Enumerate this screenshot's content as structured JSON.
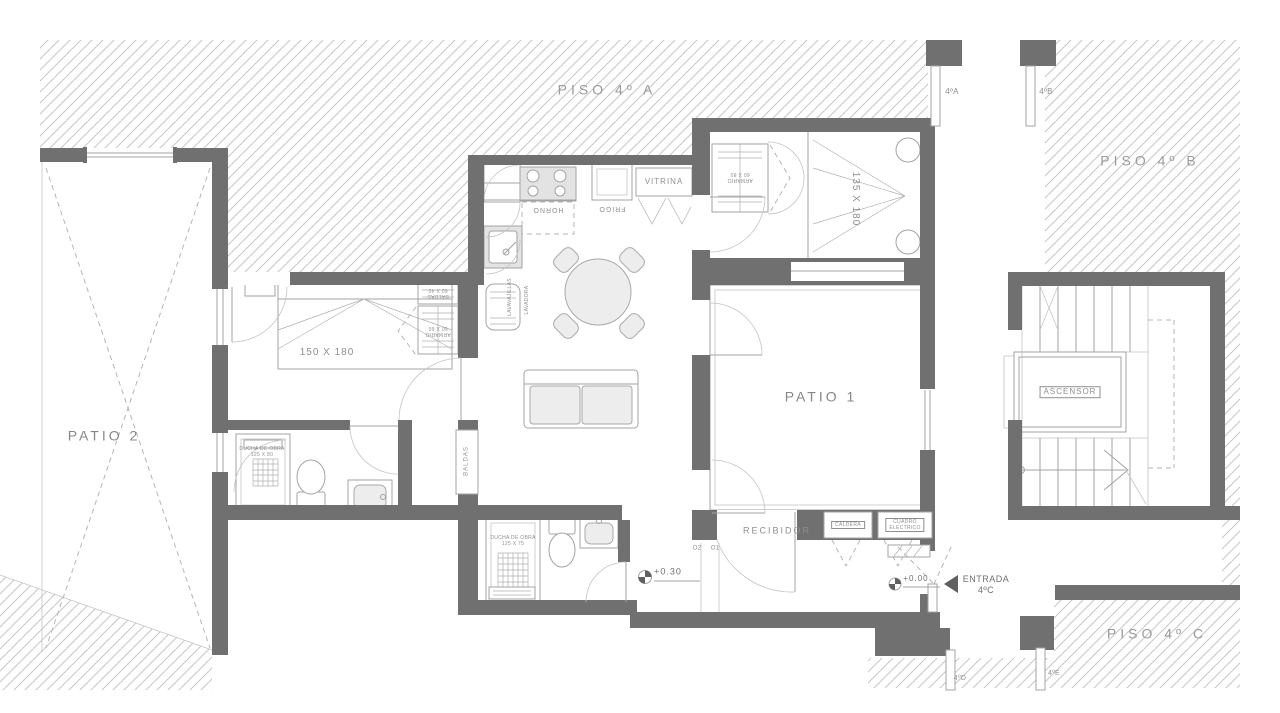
{
  "areas": {
    "piso_a": "PISO 4º A",
    "piso_b": "PISO 4º B",
    "piso_c": "PISO 4º C",
    "patio_1": "PATIO 1",
    "patio_2": "PATIO 2",
    "recibidor": "RECIBIDOR"
  },
  "kitchen": {
    "vitrina": "VITRINA",
    "horno": "HORNO",
    "frigo": "FRIGO",
    "lavavajillas": "LAVAVAJILLAS",
    "lavadora": "LAVADORA"
  },
  "bedrooms": {
    "bed_left_size": "150 X 180",
    "bed_right_size": "135 X 180",
    "baldas_unit": "BALDAS\n60 X 40",
    "armario_left": "ARMARIO\n60 X 60",
    "armario_right": "ARMARIO\n60 X 80"
  },
  "bathrooms": {
    "ducha_1": "DUCHA DE OBRA\n125 X 80",
    "ducha_2": "DUCHA DE OBRA\n125 X 75"
  },
  "storage": {
    "baldas_niche": "BALDAS"
  },
  "services": {
    "ascensor": "ASCENSOR",
    "caldera": "CALDERA",
    "cuadro_electrico": "CUADRO\nELECTRICO"
  },
  "markers": {
    "level_high": "+0.30",
    "level_entry": "+0.00",
    "entrada": "ENTRADA\n4ºC",
    "step_1": "O1",
    "step_2": "O2"
  },
  "doors": {
    "a": "4ºA",
    "b": "4ºB",
    "d": "4ºD",
    "e": "4ºE"
  },
  "colors": {
    "wall": "#707070",
    "hatch_line": "#c6c6c6",
    "line": "#a3a3a3",
    "text": "#8f8f8f"
  }
}
